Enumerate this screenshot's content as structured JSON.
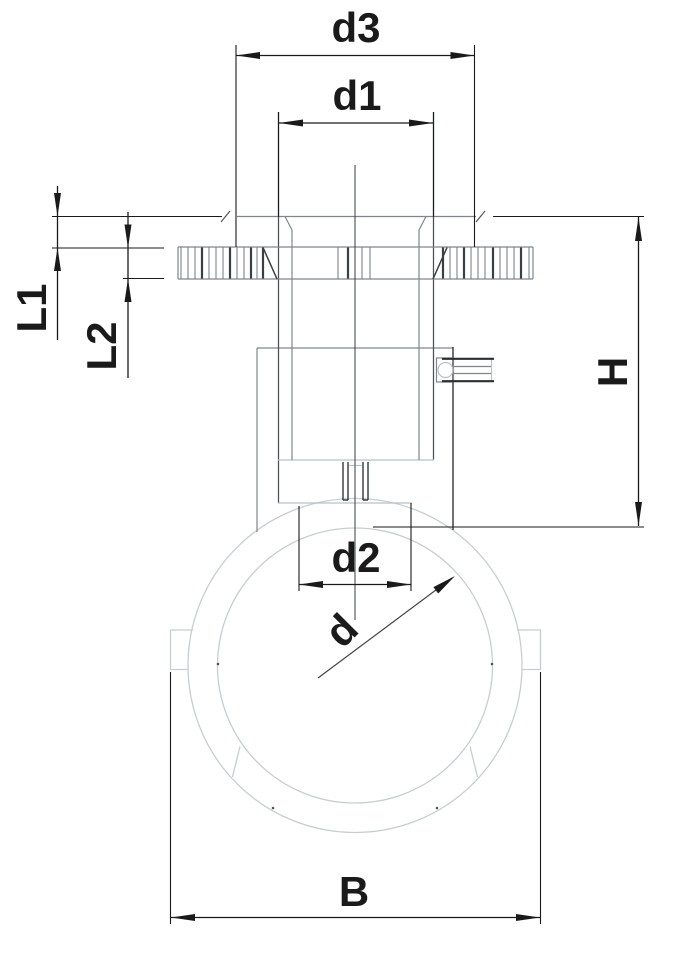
{
  "drawing": {
    "labels": {
      "d3": "d3",
      "d1": "d1",
      "L1": "L1",
      "L2": "L2",
      "H": "H",
      "d2": "d2",
      "d": "d",
      "B": "B"
    },
    "colors": {
      "background": "#ffffff",
      "dimension_lines": "#1a1a1a",
      "part_outline": "#7d868c",
      "part_outline_dark": "#34383c",
      "pipe_outline_light": "#c6ced2"
    }
  }
}
